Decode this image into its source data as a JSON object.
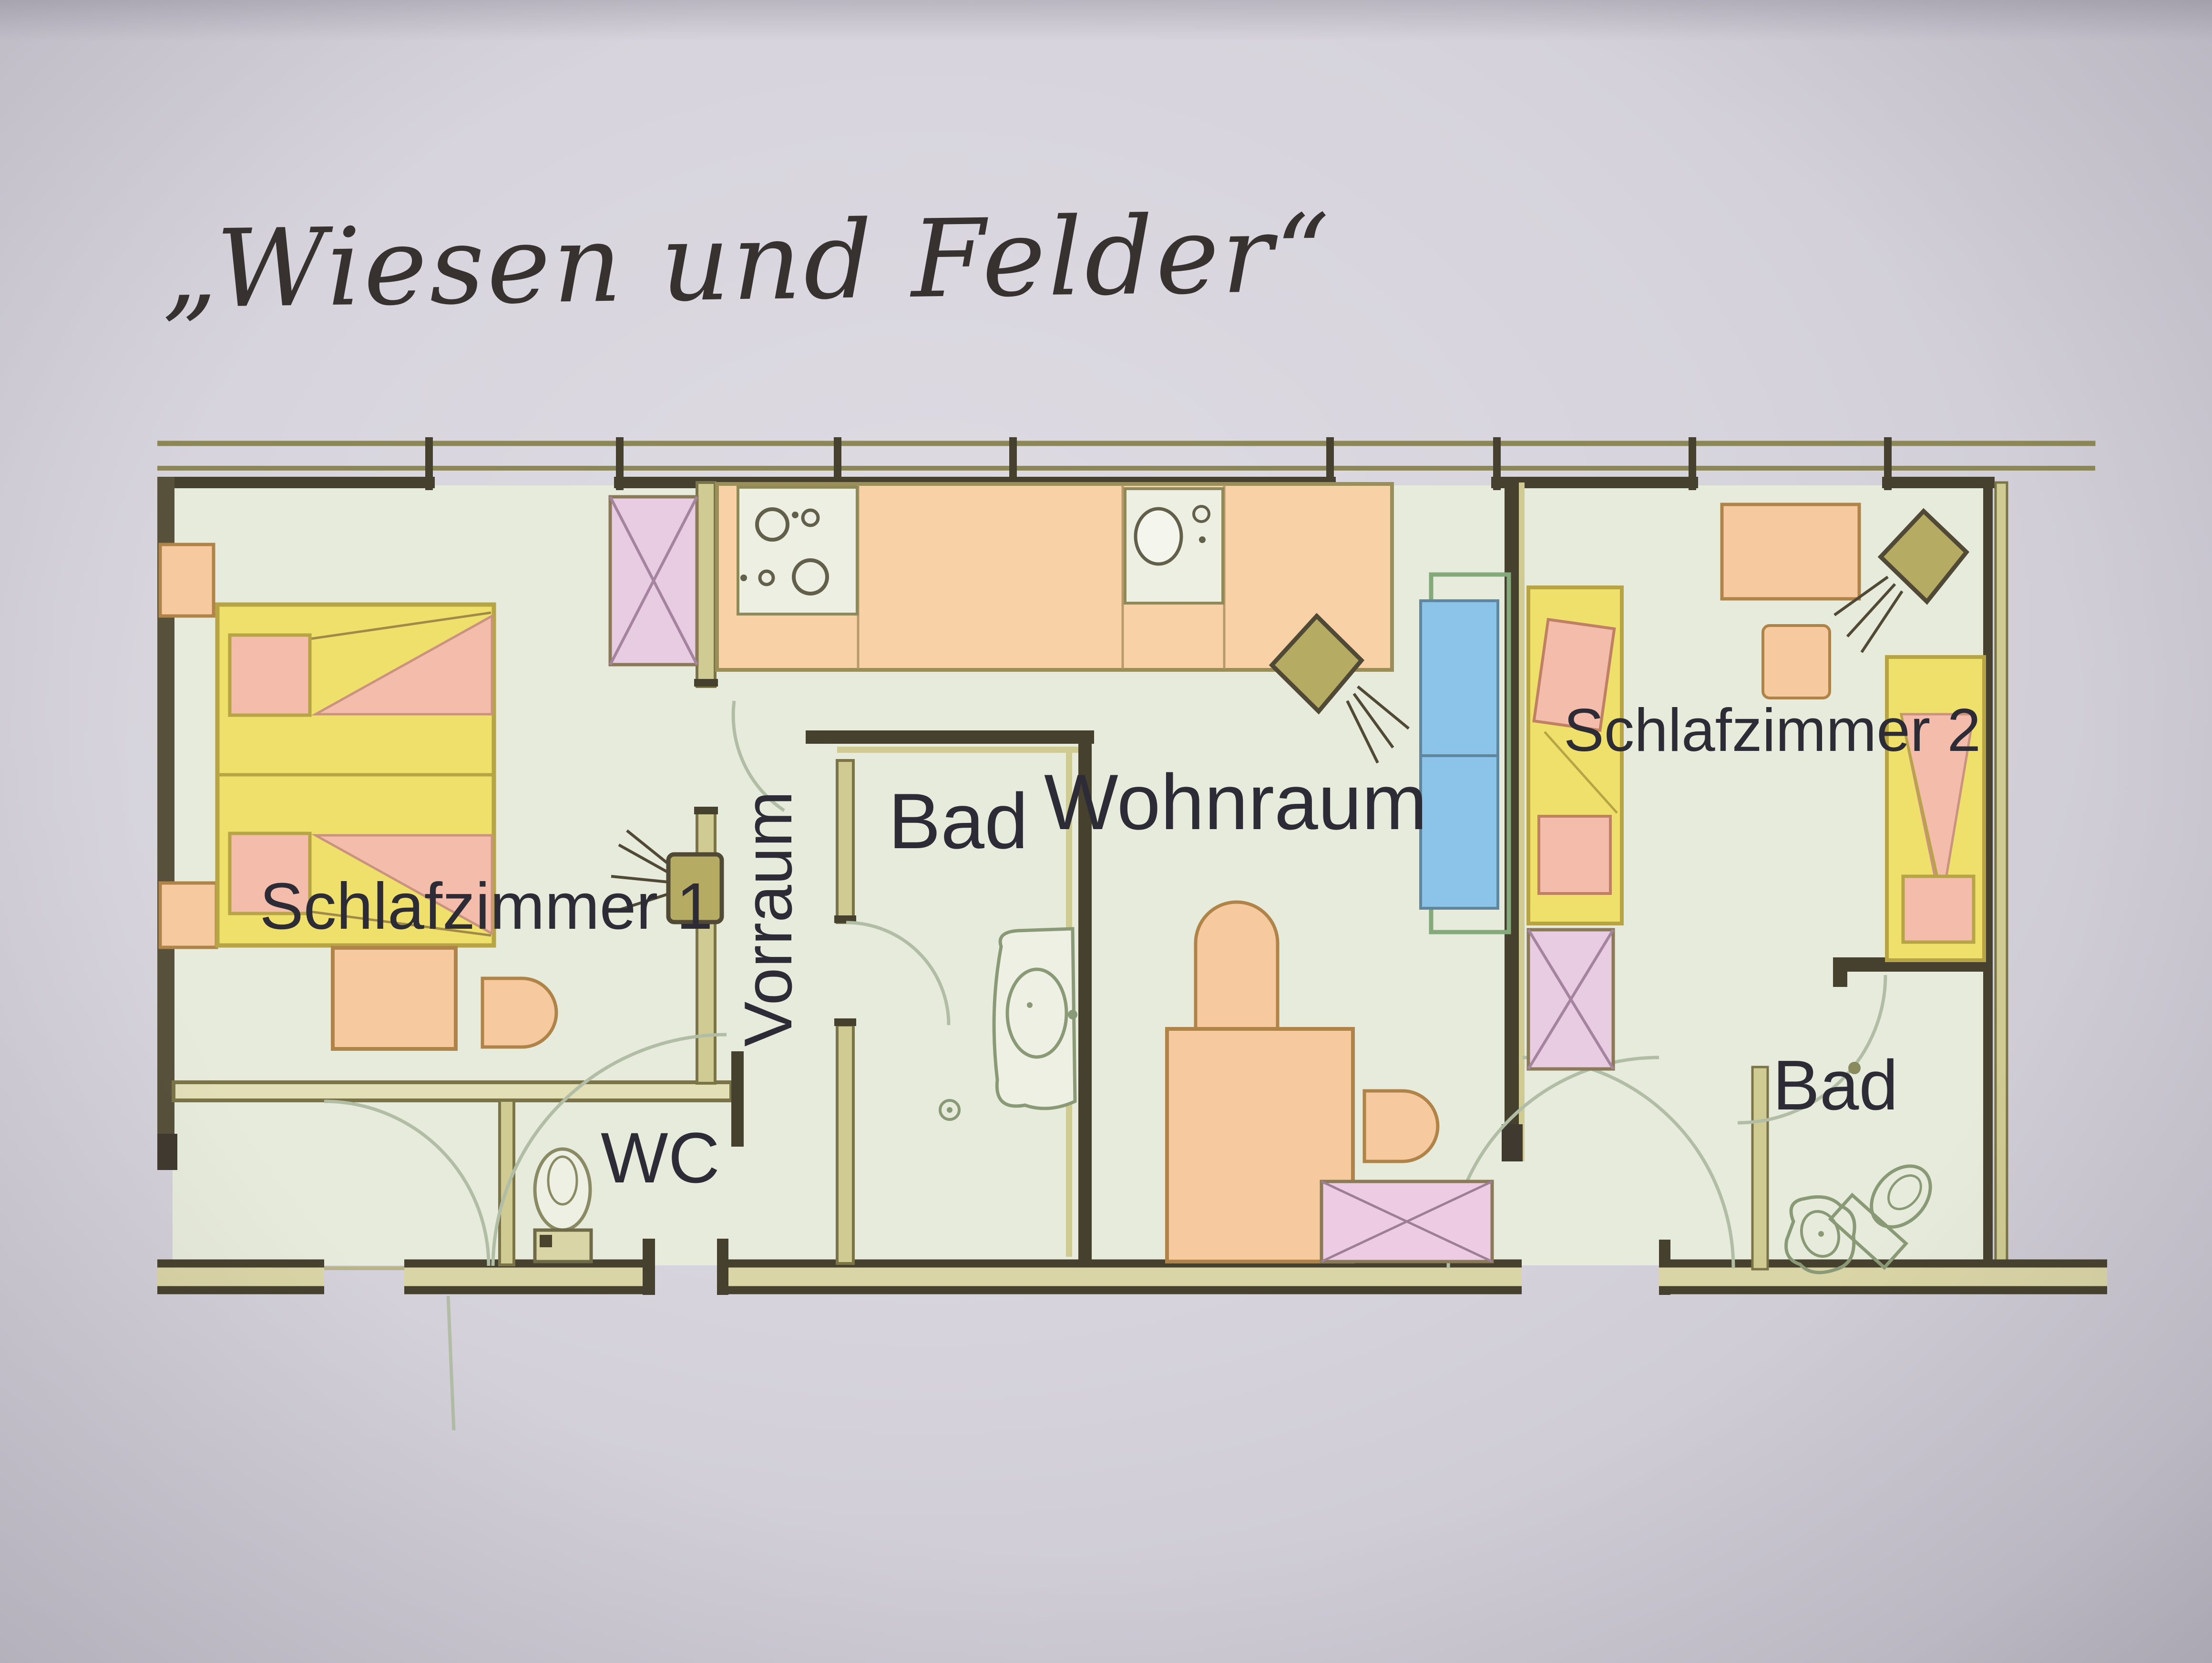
{
  "photo": {
    "title": "„Wiesen und Felder“"
  },
  "floorplan": {
    "rooms": [
      {
        "id": "schlafzimmer-1",
        "label": "Schlafzimmer 1",
        "orientation": "horizontal"
      },
      {
        "id": "wc",
        "label": "WC",
        "orientation": "horizontal"
      },
      {
        "id": "vorraum",
        "label": "Vorraum",
        "orientation": "vertical"
      },
      {
        "id": "bad-1",
        "label": "Bad",
        "orientation": "horizontal"
      },
      {
        "id": "wohnraum",
        "label": "Wohnraum",
        "orientation": "horizontal"
      },
      {
        "id": "schlafzimmer-2",
        "label": "Schlafzimmer 2",
        "orientation": "horizontal"
      },
      {
        "id": "bad-2",
        "label": "Bad",
        "orientation": "horizontal"
      }
    ],
    "palette": {
      "photo_background": "#d6d3dc",
      "paper_room_tint": "#e7ebdb",
      "wall_dark": "#46402e",
      "wall_olive_fill": "#cfcb92",
      "wall_olive_stroke": "#7b7448",
      "furniture_orange": "#f6c99e",
      "furniture_orange_stroke": "#b08448",
      "bed_yellow": "#efe06b",
      "bed_yellow_stroke": "#b7a445",
      "pillow_pink": "#f3bcab",
      "wardrobe_pink": "#e8cde2",
      "sofa_blue": "#8cc4e9",
      "tv_olive": "#b6ab63",
      "fixture_pencil_green": "#8a9a76",
      "door_arc_pencil": "#b2bda6",
      "label_color": "#2d2c36"
    }
  }
}
